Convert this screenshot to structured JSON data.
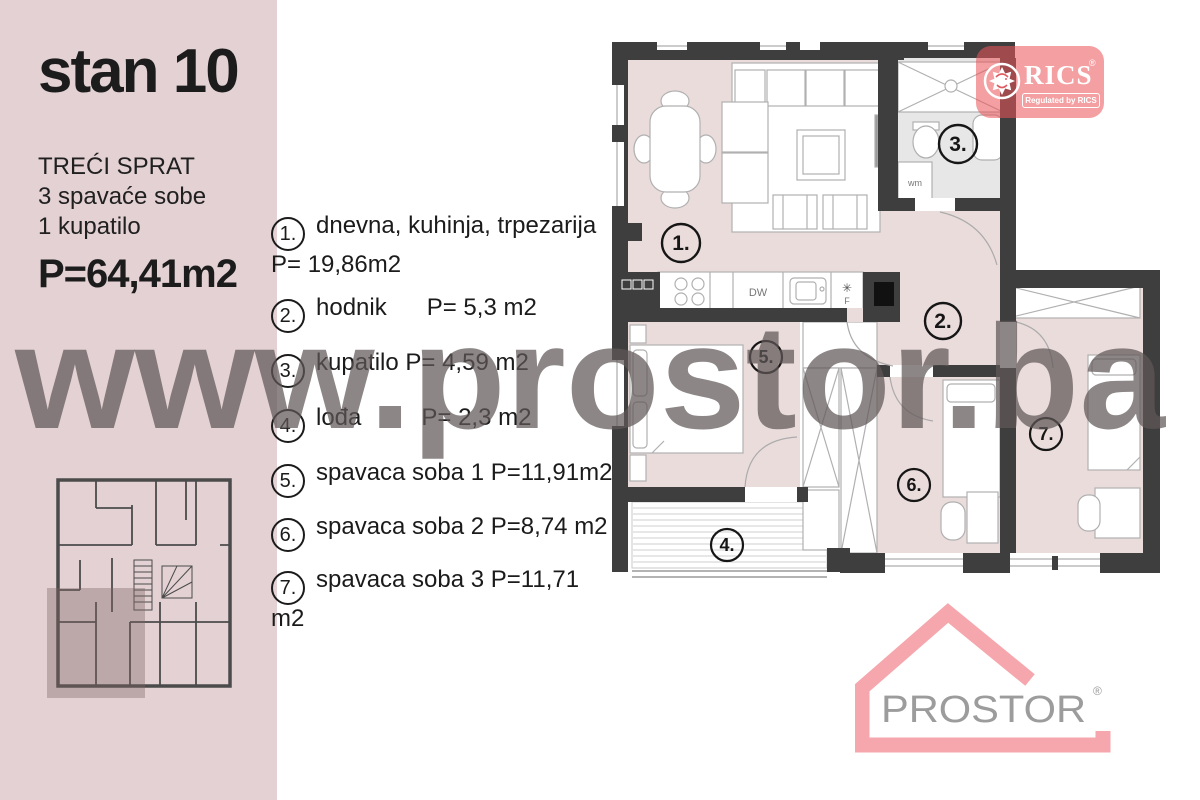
{
  "sidebar": {
    "title": "stan 10",
    "floor": "TREĆI SPRAT",
    "bedrooms": "3 spavaće sobe",
    "bathrooms": "1 kupatilo",
    "area": "P=64,41m2"
  },
  "legend": {
    "items": [
      {
        "num": "1.",
        "label": "dnevna,  kuhinja, trpezarija P= 19,86m2"
      },
      {
        "num": "2.",
        "label": "hodnik      P= 5,3 m2"
      },
      {
        "num": "3.",
        "label": "kupatilo P= 4,59 m2"
      },
      {
        "num": "4.",
        "label": "lođa         P= 2,3 m2"
      },
      {
        "num": "5.",
        "label": "spavaca soba 1 P=11,91m2"
      },
      {
        "num": "6.",
        "label": "spavaca soba 2 P=8,74 m2"
      },
      {
        "num": "7.",
        "label": "spavaca soba 3 P=11,71 m2"
      }
    ]
  },
  "watermark": "www.prostor.ba",
  "plan": {
    "room_numbers": [
      "1.",
      "2.",
      "3.",
      "4.",
      "5.",
      "6.",
      "7."
    ],
    "labels": {
      "wm": "wm",
      "dw": "DW",
      "f": "F"
    }
  },
  "rics": {
    "name": "RICS",
    "reg": "®",
    "tagline": "Regulated by RICS"
  },
  "prostor": {
    "name": "PROSTOR",
    "reg": "®"
  },
  "colors": {
    "sidebar_bg": "#e3d1d3",
    "floor_pink": "#ebdcdc",
    "bath_gray": "#e7e7e7",
    "wall_dark": "#3e3e3e",
    "watermark_gray": "rgba(95,88,88,0.72)",
    "rics_red": "rgba(235,85,90,0.56)",
    "prostor_pink": "#f5a7ad",
    "prostor_gray": "#9c9c9c"
  }
}
